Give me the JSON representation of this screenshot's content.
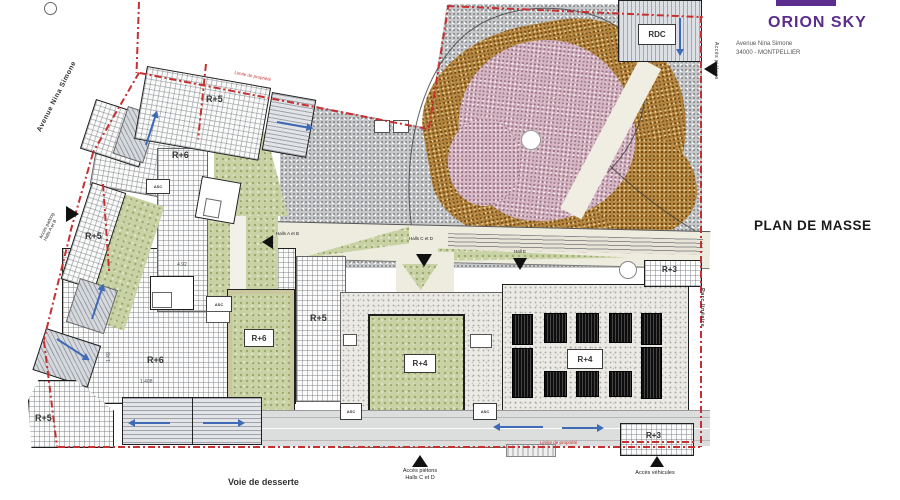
{
  "title_block": {
    "project": "ORION SKY",
    "address1": "Avenue Nina Simone",
    "address2": "34000 - MONTPELLIER"
  },
  "plan_title": "PLAN DE MASSE",
  "streets": {
    "avenue": "Avenue Nina Simone",
    "service_road": "Voie de desserte",
    "park_side": "Parc linéaire"
  },
  "floor_labels": {
    "r5_top": "R+5",
    "r6_upper": "R+6",
    "r5_west": "R+5",
    "r6_lower": "R+6",
    "r6_block": "R+6",
    "r5_mid": "R+5",
    "r5_corner": "R+5",
    "r4_center": "R+4",
    "r4_east": "R+4",
    "r3_north": "R+3",
    "r3_south": "R+3",
    "rdc": "RDC"
  },
  "access": {
    "pedestrian_ne": "Accès piétons",
    "parking_west_line1": "Accès parking",
    "parking_west_line2": "Halls A et B",
    "halls_ab": "Halls A et B",
    "halls_cd": "Halls C et D",
    "hall_e": "Hall E",
    "pedestrian_south_line1": "Accès piétons",
    "pedestrian_south_line2": "Halls C et D",
    "vehicles": "Accès véhicules"
  },
  "annotations": {
    "lift": "ASC",
    "boundary": "Limite de propriété",
    "dim_1": "4.92",
    "dim_2": "1.408",
    "dim_3": "1.49"
  },
  "colors": {
    "brand": "#5b2d8e",
    "boundary_red": "#c63031",
    "arrow_blue": "#3f6ab5",
    "green_roof": "#c9d2a4",
    "park_pink": "#d4b6c2",
    "park_brown": "#b5853f"
  }
}
